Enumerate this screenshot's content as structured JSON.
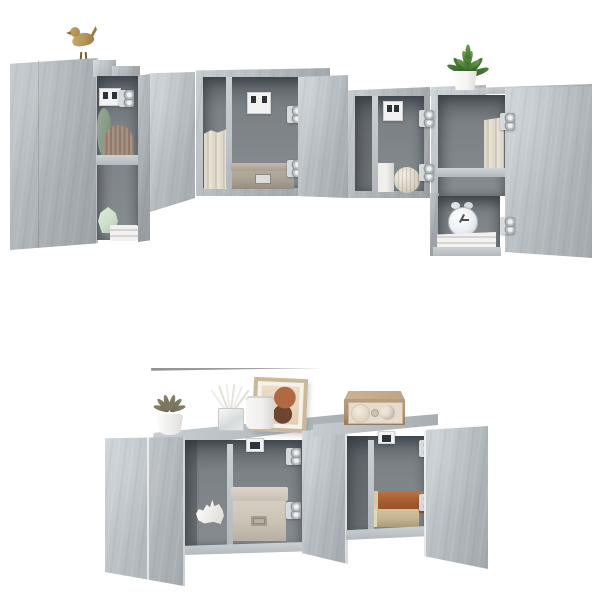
{
  "scene": {
    "description": "Product photo: 6-piece wall-mounted TV cabinet set in concrete grey with open doors, styled decor and a black flat-screen TV on a white background",
    "background_color": "#ffffff"
  },
  "palette": {
    "bg": "#ffffff",
    "concrete": "#aeb4b8",
    "concrete_light": "#c3c9cd",
    "concrete_dark": "#9aa0a4",
    "interior": "#7b8185",
    "interior_shadow": "#5f656a",
    "shelf_edge": "#ccd1d4",
    "tv_screen": "#262626",
    "tv_base": "#a6a8aa",
    "gold": "#b5965a",
    "plant_green": "#4e8038",
    "pot_white": "#f5f5f3",
    "succulent": "#8a8168",
    "mint": "#cfe0cd",
    "sage": "#879a87",
    "pleats": "#a8927f",
    "cream_books": "#ded8cb",
    "box_taupe": "#a89f93",
    "box_beige": "#cdc5b8",
    "book_rust": "#a85f33",
    "book_tan": "#c6b592",
    "clock": "#eceff1",
    "radio_wood": "#ac9174",
    "radio_face": "#e5dccd",
    "frame_wood": "#c9b89b",
    "art_terracotta": "#b06a42",
    "art_brown": "#6d4531",
    "hinge": "#c9ccce",
    "bracket": "#f2f2f2",
    "white_decor": "#f1f0ee"
  },
  "objects": {
    "set": "concrete grey wall-mounted TV cabinet set with open doors",
    "tv": "wall-mounted black flat-screen TV",
    "bird": "gold bird figurine",
    "plant": "green plant in white pot",
    "succulent": "succulent in white pot",
    "diffuser": "glass reed diffuser",
    "vase_cylinder": "white cylinder vase",
    "frame": "framed abstract art print",
    "radio": "wooden retro radio",
    "clock": "twin-bell alarm clock",
    "rhino": "white origami rhino figurine",
    "box_taupe": "taupe storage box with metal label",
    "box_beige": "beige fabric storage box",
    "books_cream": "cream standing books",
    "books_stacked": "stacked rust and tan books",
    "vase_square": "white square vase",
    "vase_sphere": "ribbed sphere vase",
    "fan_decor": "pleated fan decor",
    "vase_mint": "mint geometric vase",
    "vase_sage": "sage ceramic vase",
    "white_stack": "stack of white books",
    "wall_bracket": "white wall-mount bracket",
    "hinge": "metal cabinet hinge"
  }
}
